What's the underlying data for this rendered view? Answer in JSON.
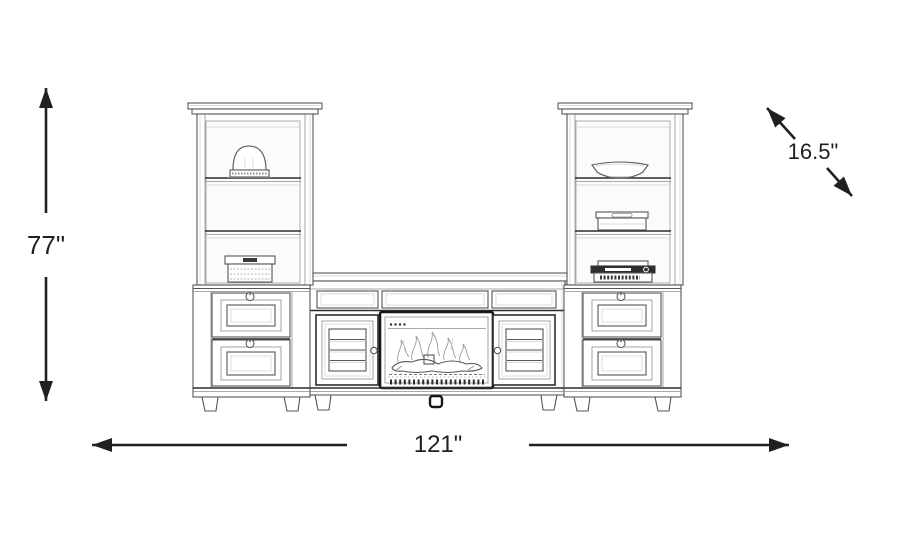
{
  "diagram": {
    "type": "furniture-dimension-line-drawing",
    "subject": "4-piece wall unit: two bookcase piers with drawers flanking a fireplace TV console",
    "dimension_labels": {
      "height": "77\"",
      "width": "121\"",
      "depth": "16.5\""
    },
    "dimension_values": {
      "height_in": 77,
      "width_in": 121,
      "depth_in": 16.5
    },
    "colors": {
      "background": "#ffffff",
      "arrow": "#231f20",
      "sketch_line": "#565656",
      "sketch_line_light": "#8d8d8d",
      "fireplace_frame": "#171717"
    }
  }
}
